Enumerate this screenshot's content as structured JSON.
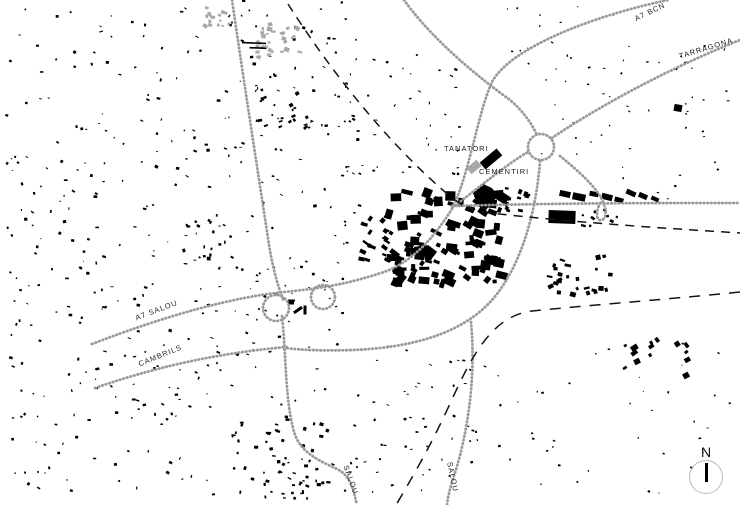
{
  "map_title": "Figure-ground urban plan with road network",
  "colors": {
    "background": "#ffffff",
    "building_black": "#000000",
    "building_gray": "#a8a8a8",
    "road_dot": "#9a9a9a",
    "railway": "#141414",
    "label": "#222222",
    "north_circle": "#b9b9b9"
  },
  "north": {
    "label": "N"
  },
  "map_labels": {
    "a7_bcn": {
      "text": "A7 BCN",
      "x": 633,
      "y": 15,
      "rotate": -26
    },
    "tarragona": {
      "text": "TARRAGONA",
      "x": 678,
      "y": 52,
      "rotate": -17
    },
    "tanatori": {
      "text": "TANATORI",
      "x": 444,
      "y": 144,
      "rotate": 0
    },
    "cementiri": {
      "text": "CEMENTIRI",
      "x": 479,
      "y": 167,
      "rotate": 0
    },
    "a7_salou": {
      "text": "A7 SALOU",
      "x": 134,
      "y": 314,
      "rotate": -21
    },
    "cambrils": {
      "text": "CAMBRILS",
      "x": 137,
      "y": 360,
      "rotate": -22
    },
    "salou_sw": {
      "text": "SALOU",
      "x": 350,
      "y": 464,
      "rotate": 70
    },
    "salou_se": {
      "text": "SALOU",
      "x": 454,
      "y": 461,
      "rotate": 78
    }
  },
  "roads": [
    {
      "id": "road-north-access",
      "path": "M232,0 C244,82 256,160 268,238 C272,266 278,287 284,302"
    },
    {
      "id": "road-south-salou-w",
      "path": "M282,316 C286,352 285,396 293,428 C298,450 313,458 337,469 C351,476 353,489 357,505"
    },
    {
      "id": "road-a7",
      "path": "M92,344 C170,314 235,297 284,292 C335,287 356,281 384,272 C414,261 434,237 452,209"
    },
    {
      "id": "road-a7-bcn",
      "path": "M452,208 C468,180 478,112 492,82 C510,48 592,16 668,0"
    },
    {
      "id": "road-tarragona",
      "path": "M552,138 C590,112 660,72 740,40"
    },
    {
      "id": "road-nw-link",
      "path": "M404,0 C424,28 458,62 506,97 C520,107 531,122 537,135"
    },
    {
      "id": "road-town-roundabout",
      "path": "M452,208 C478,188 510,162 528,152"
    },
    {
      "id": "road-east-west",
      "path": "M452,206 C560,203 650,203 740,203"
    },
    {
      "id": "road-ramp-hook",
      "path": "M560,156 C581,173 594,186 600,196 C606,206 608,217 602,220 C596,222 595,211 601,202"
    },
    {
      "id": "road-ring-arc",
      "path": "M540,161 C536,215 520,268 492,300 C462,334 410,348 352,350 C325,351 300,350 286,348"
    },
    {
      "id": "road-salou-e",
      "path": "M471,322 C475,365 471,408 462,447 C456,474 449,486 447,505"
    },
    {
      "id": "road-cambrils",
      "path": "M95,388 C170,362 232,352 286,347"
    }
  ],
  "road_circles": [
    {
      "id": "interchange-west",
      "cx": 276,
      "cy": 308,
      "r": 13
    },
    {
      "id": "interchange-east",
      "cx": 323,
      "cy": 297,
      "r": 12
    },
    {
      "id": "roundabout-ne",
      "cx": 541,
      "cy": 147,
      "r": 13
    }
  ],
  "railways": [
    {
      "id": "railway-north-east",
      "path": "M288,4 C330,70 385,140 445,192 C460,205 470,210 490,213 C570,222 660,228 740,233",
      "dash": "9 7"
    },
    {
      "id": "railway-south",
      "path": "M740,292 C660,300 580,306 532,311 C490,316 470,360 448,408 C430,447 412,478 396,505",
      "dash": "11 9"
    }
  ],
  "buildings": {
    "explicit": [
      {
        "x": 491,
        "y": 159,
        "w": 22,
        "h": 9,
        "r": -40,
        "f": "b",
        "name": "tanatori-building"
      },
      {
        "x": 474,
        "y": 167,
        "w": 13,
        "h": 8,
        "r": -40,
        "f": "g",
        "name": "cementiri-building"
      },
      {
        "x": 562,
        "y": 217,
        "w": 27,
        "h": 13,
        "r": 2,
        "f": "b"
      },
      {
        "x": 565,
        "y": 194,
        "w": 11,
        "h": 6,
        "r": 12,
        "f": "b"
      },
      {
        "x": 579,
        "y": 197,
        "w": 13,
        "h": 7,
        "r": 12,
        "f": "b"
      },
      {
        "x": 594,
        "y": 194,
        "w": 9,
        "h": 5,
        "r": 10,
        "f": "b"
      },
      {
        "x": 607,
        "y": 197,
        "w": 11,
        "h": 6,
        "r": 14,
        "f": "b"
      },
      {
        "x": 619,
        "y": 200,
        "w": 9,
        "h": 5,
        "r": 16,
        "f": "b"
      },
      {
        "x": 631,
        "y": 193,
        "w": 10,
        "h": 5,
        "r": 24,
        "f": "b"
      },
      {
        "x": 643,
        "y": 196,
        "w": 9,
        "h": 5,
        "r": 24,
        "f": "b"
      },
      {
        "x": 655,
        "y": 199,
        "w": 8,
        "h": 4,
        "r": 24,
        "f": "b"
      },
      {
        "x": 254,
        "y": 43,
        "w": 24,
        "h": 1.6,
        "r": 2,
        "f": "b"
      },
      {
        "x": 258,
        "y": 48,
        "w": 17,
        "h": 1.6,
        "r": 2,
        "f": "b"
      },
      {
        "x": 291,
        "y": 302,
        "w": 6,
        "h": 5,
        "r": 0,
        "f": "b"
      },
      {
        "x": 298,
        "y": 310,
        "w": 10,
        "h": 3,
        "r": -35,
        "f": "b"
      },
      {
        "x": 305,
        "y": 310,
        "w": 3,
        "h": 9,
        "r": 0,
        "f": "b"
      },
      {
        "x": 470,
        "y": 209,
        "w": 9,
        "h": 6,
        "r": 20,
        "f": "b"
      },
      {
        "x": 678,
        "y": 108,
        "w": 8,
        "h": 7,
        "r": 10,
        "f": "b"
      }
    ],
    "polygons": [
      {
        "pts": "473,193 483,184 492,188 497,197 489,206 477,204",
        "f": "b",
        "name": "cemetery-block"
      }
    ],
    "clusters": [
      {
        "x": 6,
        "y": 6,
        "w": 215,
        "h": 300,
        "n": 150,
        "s1": 1,
        "s2": 3.8,
        "seed": 1,
        "f": "b"
      },
      {
        "x": 6,
        "y": 300,
        "w": 215,
        "h": 195,
        "n": 110,
        "s1": 1,
        "s2": 3.8,
        "seed": 2,
        "f": "b"
      },
      {
        "x": 225,
        "y": 0,
        "w": 135,
        "h": 250,
        "n": 85,
        "s1": 1,
        "s2": 3.6,
        "seed": 3,
        "f": "b"
      },
      {
        "x": 228,
        "y": 255,
        "w": 115,
        "h": 150,
        "n": 55,
        "s1": 1,
        "s2": 3.2,
        "seed": 4,
        "f": "b"
      },
      {
        "x": 335,
        "y": 55,
        "w": 125,
        "h": 125,
        "n": 48,
        "s1": 1,
        "s2": 3.4,
        "seed": 5,
        "f": "b"
      },
      {
        "x": 505,
        "y": 5,
        "w": 125,
        "h": 105,
        "n": 26,
        "s1": 1,
        "s2": 2.8,
        "seed": 6,
        "f": "b"
      },
      {
        "x": 625,
        "y": 45,
        "w": 108,
        "h": 70,
        "n": 20,
        "s1": 1,
        "s2": 2.8,
        "seed": 7,
        "f": "b"
      },
      {
        "x": 345,
        "y": 345,
        "w": 175,
        "h": 150,
        "n": 60,
        "s1": 1,
        "s2": 3.2,
        "seed": 8,
        "f": "b"
      },
      {
        "x": 525,
        "y": 335,
        "w": 205,
        "h": 160,
        "n": 34,
        "s1": 1,
        "s2": 2.8,
        "seed": 9,
        "f": "b"
      },
      {
        "x": 535,
        "y": 115,
        "w": 195,
        "h": 85,
        "n": 20,
        "s1": 1,
        "s2": 2.6,
        "seed": 10,
        "f": "b"
      },
      {
        "x": 232,
        "y": 412,
        "w": 105,
        "h": 88,
        "n": 48,
        "s1": 1.5,
        "s2": 4.5,
        "seed": 11,
        "f": "b"
      },
      {
        "x": 252,
        "y": 82,
        "w": 58,
        "h": 52,
        "n": 22,
        "s1": 1.5,
        "s2": 4.5,
        "seed": 12,
        "f": "b",
        "rmin": -40,
        "rmax": -10
      },
      {
        "x": 183,
        "y": 218,
        "w": 48,
        "h": 42,
        "n": 16,
        "s1": 1.5,
        "s2": 4.5,
        "seed": 13,
        "f": "b"
      },
      {
        "x": 388,
        "y": 192,
        "w": 118,
        "h": 92,
        "n": 88,
        "s1": 3.5,
        "s2": 12,
        "seed": 14,
        "f": "b",
        "rmin": -8,
        "rmax": 38
      },
      {
        "x": 392,
        "y": 240,
        "w": 66,
        "h": 48,
        "n": 26,
        "s1": 3,
        "s2": 9,
        "seed": 15,
        "f": "b",
        "rmin": -8,
        "rmax": 38
      },
      {
        "x": 358,
        "y": 210,
        "w": 32,
        "h": 58,
        "n": 20,
        "s1": 2.5,
        "s2": 7,
        "seed": 16,
        "f": "b",
        "rmin": 10,
        "rmax": 40
      },
      {
        "x": 505,
        "y": 186,
        "w": 28,
        "h": 28,
        "n": 12,
        "s1": 2.5,
        "s2": 6.5,
        "seed": 17,
        "f": "b",
        "rmin": 5,
        "rmax": 25
      },
      {
        "x": 548,
        "y": 255,
        "w": 72,
        "h": 40,
        "n": 26,
        "s1": 2.5,
        "s2": 6.5,
        "seed": 18,
        "f": "b",
        "rmin": -30,
        "rmax": 20
      },
      {
        "x": 620,
        "y": 336,
        "w": 70,
        "h": 40,
        "n": 14,
        "s1": 3,
        "s2": 7.5,
        "seed": 19,
        "f": "b",
        "rmin": -40,
        "rmax": -25
      },
      {
        "x": 205,
        "y": 6,
        "w": 26,
        "h": 22,
        "n": 15,
        "s1": 2,
        "s2": 5,
        "seed": 20,
        "f": "g"
      },
      {
        "x": 262,
        "y": 24,
        "w": 40,
        "h": 28,
        "n": 24,
        "s1": 2,
        "s2": 5.5,
        "seed": 21,
        "f": "g"
      },
      {
        "x": 256,
        "y": 42,
        "w": 18,
        "h": 16,
        "n": 8,
        "s1": 2,
        "s2": 4.5,
        "seed": 22,
        "f": "g"
      },
      {
        "x": 280,
        "y": 460,
        "w": 40,
        "h": 42,
        "n": 18,
        "s1": 1.5,
        "s2": 4,
        "seed": 23,
        "f": "b"
      },
      {
        "x": 560,
        "y": 206,
        "w": 60,
        "h": 20,
        "n": 10,
        "s1": 2,
        "s2": 5,
        "seed": 24,
        "f": "b"
      }
    ]
  }
}
